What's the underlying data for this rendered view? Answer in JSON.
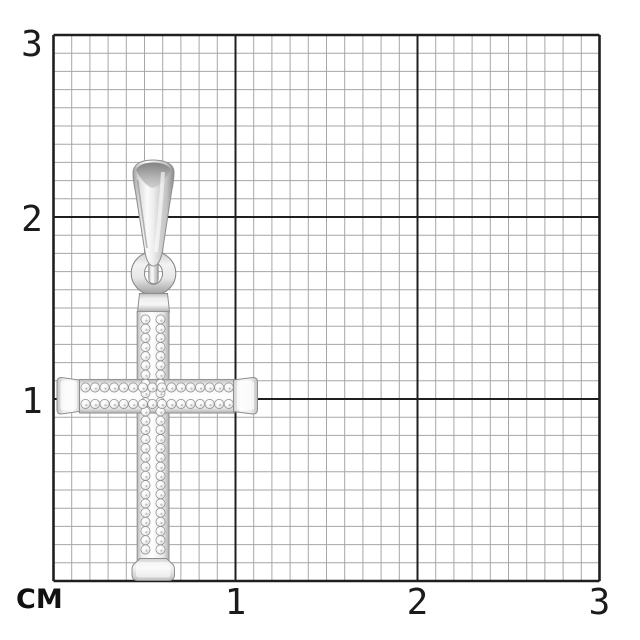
{
  "page": {
    "background": "#ffffff"
  },
  "axes": {
    "unit": "СМ",
    "x_ticks": [
      "1",
      "2",
      "3"
    ],
    "y_ticks": [
      "3",
      "2",
      "1"
    ],
    "label_color": "#1b1b1b"
  },
  "grid": {
    "minor_color": "#a6a6a6",
    "major_color": "#1f1f1f",
    "background": "#ffffff",
    "minor_cells_per_cm": 10,
    "extent_cm": 3
  },
  "figure": {
    "subject": "pave-diamond-cross-pendant",
    "metal_light": "#ffffff",
    "metal_mid": "#d9d9d9",
    "metal_dark": "#8a8a8a",
    "stone_edge": "#8c8c8c"
  }
}
